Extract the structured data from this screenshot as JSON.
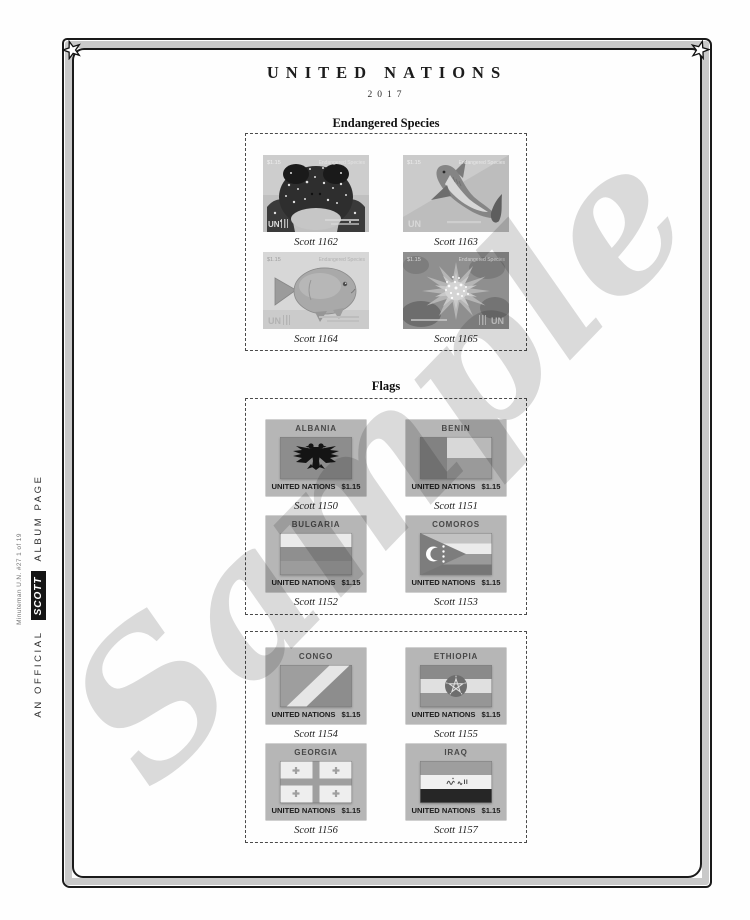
{
  "header": {
    "title": "UNITED NATIONS",
    "year": "2017"
  },
  "watermark": "Sample",
  "sidebar": {
    "edition": "Minuteman U.N. #27 1 of 19",
    "prefix": "AN OFFICIAL",
    "brand": "SCOTT",
    "suffix": "ALBUM PAGE"
  },
  "endangered": {
    "heading": "Endangered Species",
    "denom": "$1.15",
    "series": "Endangered Species",
    "un": "UN",
    "stamps": [
      {
        "caption": "Scott 1162"
      },
      {
        "caption": "Scott 1163"
      },
      {
        "caption": "Scott 1164"
      },
      {
        "caption": "Scott 1165"
      }
    ]
  },
  "flags": {
    "heading": "Flags",
    "un_label": "UNITED NATIONS",
    "denom": "$1.15",
    "group1": [
      {
        "country": "ALBANIA",
        "caption": "Scott 1150"
      },
      {
        "country": "BENIN",
        "caption": "Scott 1151"
      },
      {
        "country": "BULGARIA",
        "caption": "Scott 1152"
      },
      {
        "country": "COMOROS",
        "caption": "Scott 1153"
      }
    ],
    "group2": [
      {
        "country": "CONGO",
        "caption": "Scott 1154"
      },
      {
        "country": "ETHIOPIA",
        "caption": "Scott 1155"
      },
      {
        "country": "GEORGIA",
        "caption": "Scott 1156"
      },
      {
        "country": "IRAQ",
        "caption": "Scott 1157"
      }
    ]
  }
}
